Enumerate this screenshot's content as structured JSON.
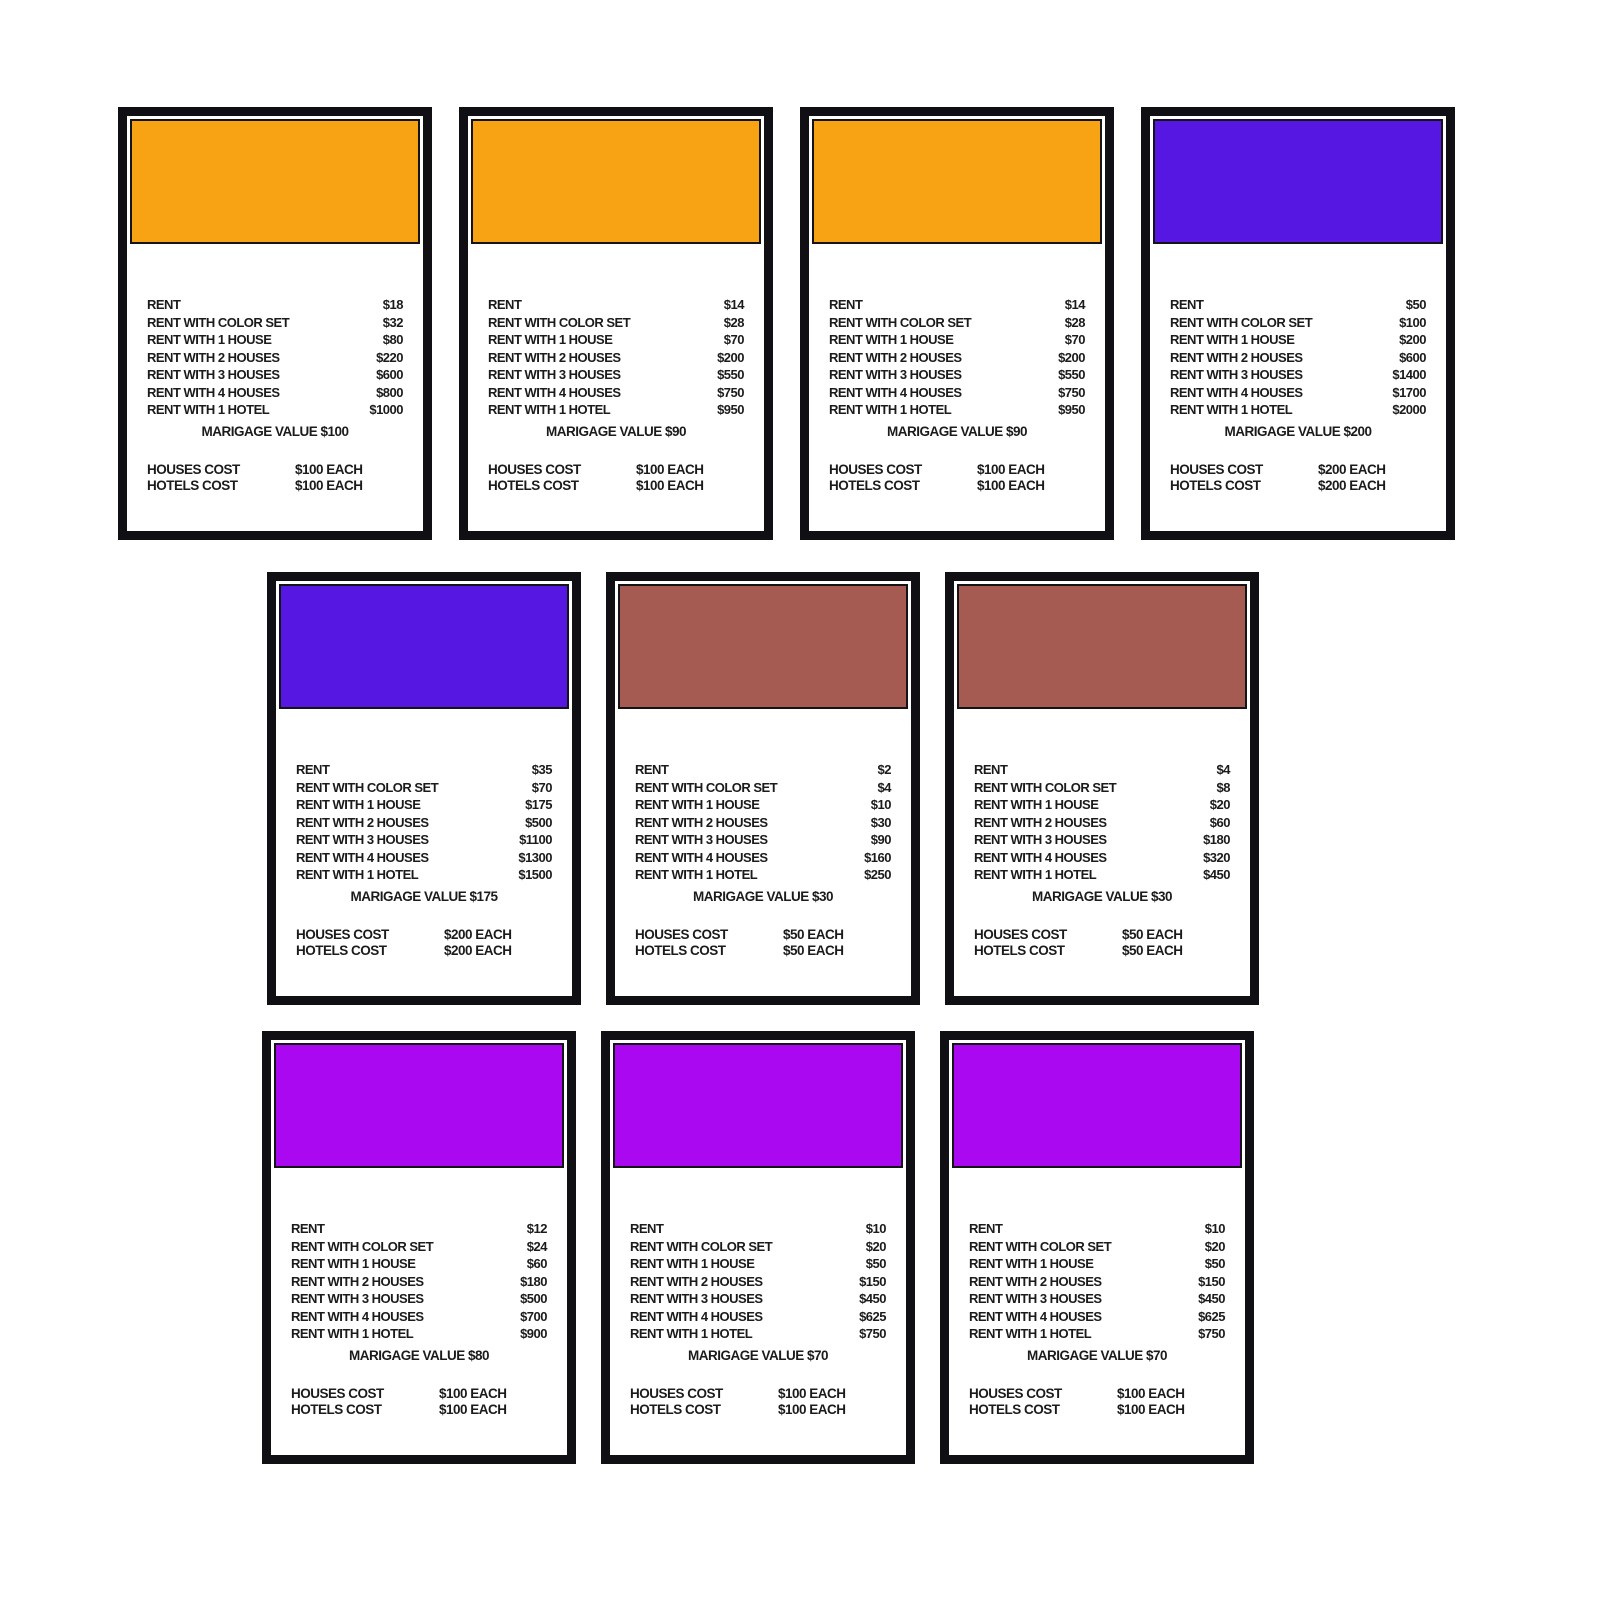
{
  "page": {
    "background": "#ffffff",
    "description_labels": {
      "rent": "RENT",
      "rent_color_set": "RENT WITH COLOR SET",
      "rent_1_house": "RENT WITH 1 HOUSE",
      "rent_2_houses": "RENT WITH 2 HOUSES",
      "rent_3_houses": "RENT WITH 3 HOUSES",
      "rent_4_houses": "RENT WITH 4 HOUSES",
      "rent_1_hotel": "RENT WITH 1 HOTEL",
      "houses_cost": "HOUSES COST",
      "hotels_cost": "HOTELS COST"
    }
  },
  "labels": {
    "rent": "RENT",
    "rent_color_set": "RENT WITH COLOR SET",
    "rent_1_house": "RENT WITH 1 HOUSE",
    "rent_2_houses": "RENT WITH 2 HOUSES",
    "rent_3_houses": "RENT WITH 3 HOUSES",
    "rent_4_houses": "RENT WITH 4 HOUSES",
    "rent_1_hotel": "RENT WITH 1 HOTEL",
    "houses_cost": "HOUSES COST",
    "hotels_cost": "HOTELS COST"
  },
  "palette": {
    "card_border": "#101014",
    "orange": "#F7A314",
    "violet": "#5617E3",
    "brown": "#A55B52",
    "magenta": "#AA08F0"
  },
  "cards": [
    {
      "color_name": "orange",
      "color": "#F7A314",
      "rents": {
        "rent": "$18",
        "color_set": "$32",
        "house1": "$80",
        "houses2": "$220",
        "houses3": "$600",
        "houses4": "$800",
        "hotel": "$1000"
      },
      "marigage": "MARIGAGE VALUE $100",
      "houses_cost": "$100 EACH",
      "hotels_cost": "$100 EACH"
    },
    {
      "color_name": "orange",
      "color": "#F7A314",
      "rents": {
        "rent": "$14",
        "color_set": "$28",
        "house1": "$70",
        "houses2": "$200",
        "houses3": "$550",
        "houses4": "$750",
        "hotel": "$950"
      },
      "marigage": "MARIGAGE VALUE $90",
      "houses_cost": "$100 EACH",
      "hotels_cost": "$100 EACH"
    },
    {
      "color_name": "orange",
      "color": "#F7A314",
      "rents": {
        "rent": "$14",
        "color_set": "$28",
        "house1": "$70",
        "houses2": "$200",
        "houses3": "$550",
        "houses4": "$750",
        "hotel": "$950"
      },
      "marigage": "MARIGAGE VALUE $90",
      "houses_cost": "$100 EACH",
      "hotels_cost": "$100 EACH"
    },
    {
      "color_name": "violet",
      "color": "#5617E3",
      "rents": {
        "rent": "$50",
        "color_set": "$100",
        "house1": "$200",
        "houses2": "$600",
        "houses3": "$1400",
        "houses4": "$1700",
        "hotel": "$2000"
      },
      "marigage": "MARIGAGE VALUE $200",
      "houses_cost": "$200 EACH",
      "hotels_cost": "$200 EACH"
    },
    {
      "color_name": "violet",
      "color": "#5617E3",
      "rents": {
        "rent": "$35",
        "color_set": "$70",
        "house1": "$175",
        "houses2": "$500",
        "houses3": "$1100",
        "houses4": "$1300",
        "hotel": "$1500"
      },
      "marigage": "MARIGAGE VALUE $175",
      "houses_cost": "$200 EACH",
      "hotels_cost": "$200 EACH"
    },
    {
      "color_name": "brown",
      "color": "#A55B52",
      "rents": {
        "rent": "$2",
        "color_set": "$4",
        "house1": "$10",
        "houses2": "$30",
        "houses3": "$90",
        "houses4": "$160",
        "hotel": "$250"
      },
      "marigage": "MARIGAGE VALUE $30",
      "houses_cost": "$50 EACH",
      "hotels_cost": "$50 EACH"
    },
    {
      "color_name": "brown",
      "color": "#A55B52",
      "rents": {
        "rent": "$4",
        "color_set": "$8",
        "house1": "$20",
        "houses2": "$60",
        "houses3": "$180",
        "houses4": "$320",
        "hotel": "$450"
      },
      "marigage": "MARIGAGE VALUE $30",
      "houses_cost": "$50 EACH",
      "hotels_cost": "$50 EACH"
    },
    {
      "color_name": "magenta",
      "color": "#AA08F0",
      "rents": {
        "rent": "$12",
        "color_set": "$24",
        "house1": "$60",
        "houses2": "$180",
        "houses3": "$500",
        "houses4": "$700",
        "hotel": "$900"
      },
      "marigage": "MARIGAGE VALUE $80",
      "houses_cost": "$100 EACH",
      "hotels_cost": "$100 EACH"
    },
    {
      "color_name": "magenta",
      "color": "#AA08F0",
      "rents": {
        "rent": "$10",
        "color_set": "$20",
        "house1": "$50",
        "houses2": "$150",
        "houses3": "$450",
        "houses4": "$625",
        "hotel": "$750"
      },
      "marigage": "MARIGAGE VALUE $70",
      "houses_cost": "$100 EACH",
      "hotels_cost": "$100 EACH"
    },
    {
      "color_name": "magenta",
      "color": "#AA08F0",
      "rents": {
        "rent": "$10",
        "color_set": "$20",
        "house1": "$50",
        "houses2": "$150",
        "houses3": "$450",
        "houses4": "$625",
        "hotel": "$750"
      },
      "marigage": "MARIGAGE VALUE $70",
      "houses_cost": "$100 EACH",
      "hotels_cost": "$100 EACH"
    }
  ]
}
